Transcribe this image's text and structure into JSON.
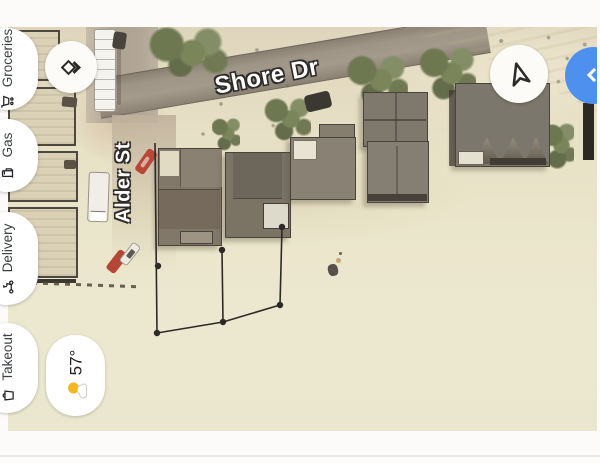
{
  "map": {
    "street_labels": {
      "shore_dr": "Shore Dr",
      "alder_st": "Alder St"
    },
    "measurement": {
      "vertices_px": [
        [
          158,
          266
        ],
        [
          157,
          333
        ],
        [
          222,
          250
        ],
        [
          223,
          322
        ],
        [
          282,
          227
        ],
        [
          280,
          305
        ]
      ]
    }
  },
  "category_chips": [
    {
      "label": "Groceries",
      "icon": "grocery-cart-icon"
    },
    {
      "label": "Gas",
      "icon": "gas-pump-icon"
    },
    {
      "label": "Delivery",
      "icon": "delivery-scooter-icon"
    },
    {
      "label": "Takeout",
      "icon": "takeout-bag-icon"
    }
  ],
  "weather_widget": {
    "temperature": "57°",
    "icon": "partly-sunny-icon"
  },
  "buttons": {
    "directions": {
      "icon": "directions-diamond-icon"
    },
    "compass": {
      "icon": "navigation-arrow-icon"
    },
    "blue_fab": {
      "icon": "chevron-left-icon",
      "color": "#3b86f0"
    }
  },
  "colors": {
    "sand": "#e9e5c9",
    "road": "#958c7e",
    "roof": "#6f675c",
    "fab_blue": "#3b86f0"
  }
}
